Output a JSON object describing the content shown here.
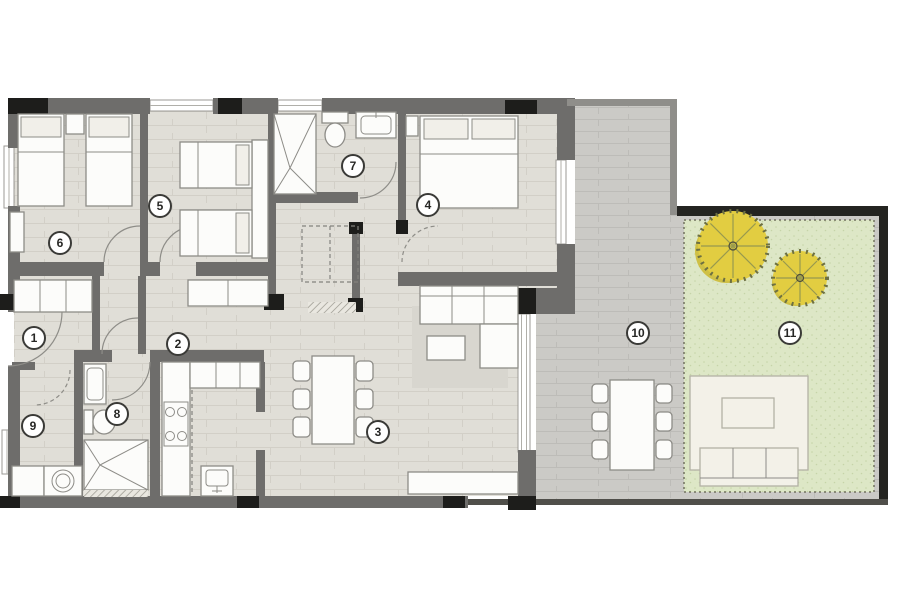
{
  "plan": {
    "kind": "apartment-floor-plan",
    "rooms": [
      {
        "id": "room-1-entrance-hall",
        "label": "1",
        "x": 34,
        "y": 338
      },
      {
        "id": "room-2-kitchen",
        "label": "2",
        "x": 178,
        "y": 344
      },
      {
        "id": "room-3-living-dining",
        "label": "3",
        "x": 378,
        "y": 432
      },
      {
        "id": "room-4-bedroom",
        "label": "4",
        "x": 428,
        "y": 205
      },
      {
        "id": "room-5-bedroom",
        "label": "5",
        "x": 160,
        "y": 206
      },
      {
        "id": "room-6-bedroom",
        "label": "6",
        "x": 60,
        "y": 243
      },
      {
        "id": "room-7-bathroom",
        "label": "7",
        "x": 353,
        "y": 166
      },
      {
        "id": "room-8-bathroom",
        "label": "8",
        "x": 117,
        "y": 414
      },
      {
        "id": "room-9-utility",
        "label": "9",
        "x": 33,
        "y": 426
      },
      {
        "id": "room-10-terrace",
        "label": "10",
        "x": 638,
        "y": 333
      },
      {
        "id": "room-11-garden",
        "label": "11",
        "x": 790,
        "y": 333
      }
    ],
    "colors": {
      "wall": "#6e6d6b",
      "black-accent": "#1d1d1b",
      "wall-dark": "#242421",
      "wall-mid": "#504f4a",
      "wall-terrace": "#8f8e8a",
      "floor-indoor": "#e0ded7",
      "floor-indoor-line": "#d2cfc7",
      "floor-terrace": "#cbcac6",
      "floor-terrace-line": "#bdbcb8",
      "grass": "#dde7c6",
      "grass-dot": "#c6d4a8",
      "garden-border": "#72725f",
      "furniture-fill": "#fcfcfa",
      "furniture-stroke": "#8d8c87",
      "tree-fill": "#e2cd41",
      "tree-shadow": "#cdb92e",
      "tree-edge": "#6d7042",
      "tree-spoke": "#97994f"
    }
  }
}
